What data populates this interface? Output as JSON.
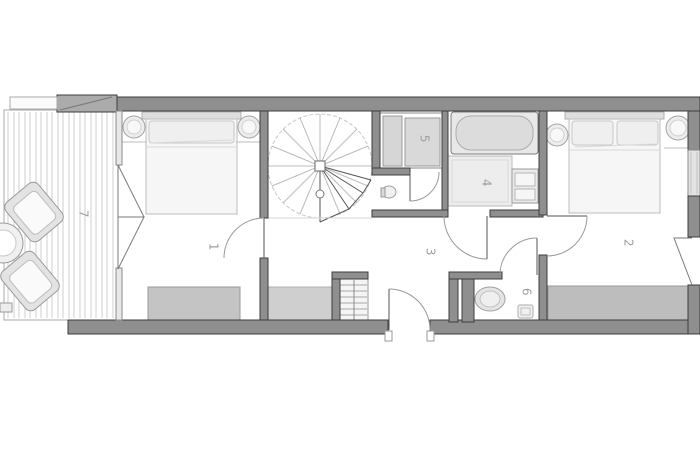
{
  "plan_title": "apartment-floor-plan",
  "rooms": {
    "bedroom_left": {
      "label": "1"
    },
    "bedroom_right": {
      "label": "2"
    },
    "hallway": {
      "label": "3"
    },
    "bathroom": {
      "label": "4"
    },
    "closet": {
      "label": "5"
    },
    "wc": {
      "label": "6"
    },
    "terrace": {
      "label": "7"
    }
  },
  "colors": {
    "background": "#ffffff",
    "wall_fill": "#8f8f8f",
    "wall_edge": "#3e3e3e",
    "light_wall": "#e6e6e6",
    "furniture_fill": "#f2f2f2",
    "furniture_edge": "#a8a8a8",
    "door_line": "#6e6e6e",
    "deck_line": "#cfcfcf",
    "label_text": "#9ba0a4"
  }
}
